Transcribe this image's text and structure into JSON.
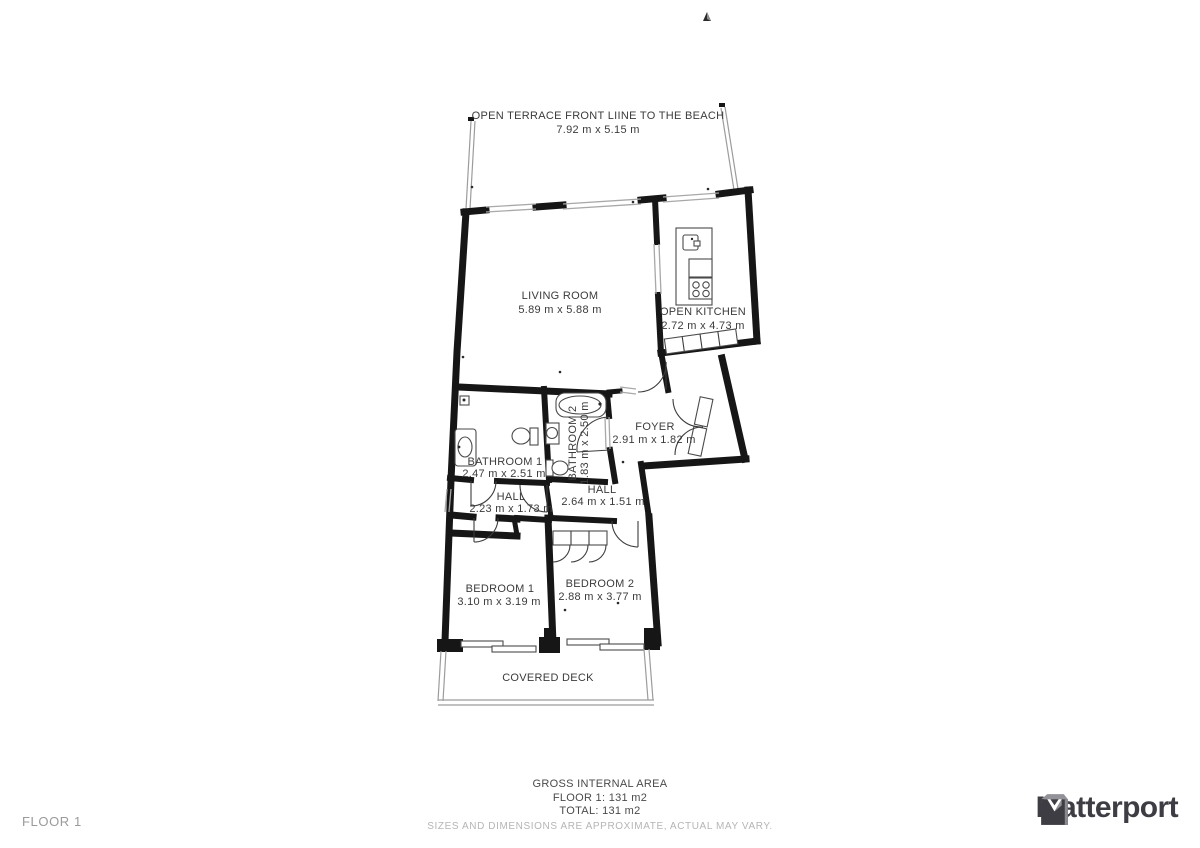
{
  "rooms": {
    "terrace": {
      "name": "OPEN TERRACE FRONT LIINE TO THE BEACH",
      "dims": "7.92 m x 5.15 m"
    },
    "living": {
      "name": "LIVING ROOM",
      "dims": "5.89 m x 5.88 m"
    },
    "kitchen": {
      "name": "OPEN KITCHEN",
      "dims": "2.72 m x 4.73 m"
    },
    "foyer": {
      "name": "FOYER",
      "dims": "2.91 m x 1.82 m"
    },
    "bathroom1": {
      "name": "BATHROOM 1",
      "dims": "2.47 m x 2.51 m"
    },
    "bathroom2": {
      "name": "BATHROOM 2",
      "dims": "1.83 m x 2.50 m"
    },
    "hall1": {
      "name": "HALL",
      "dims": "2.23 m x 1.73 m"
    },
    "hall2": {
      "name": "HALL",
      "dims": "2.64 m x 1.51 m"
    },
    "bedroom1": {
      "name": "BEDROOM 1",
      "dims": "3.10 m x 3.19 m"
    },
    "bedroom2": {
      "name": "BEDROOM 2",
      "dims": "2.88 m x 3.77 m"
    },
    "deck": {
      "name": "COVERED DECK"
    }
  },
  "legend": {
    "title": "GROSS INTERNAL AREA",
    "floor": "FLOOR 1: 131 m2",
    "total": "TOTAL: 131 m2",
    "disclaimer": "SIZES AND DIMENSIONS ARE APPROXIMATE, ACTUAL MAY VARY."
  },
  "footer": {
    "floor_label": "FLOOR 1"
  },
  "brand": {
    "name": "Matterport"
  },
  "colors": {
    "wall": "#161616",
    "label_text": "#3b3b3b",
    "muted_text": "#b5b5b5",
    "thin_line": "#a8a8a8",
    "logo": "#3e3d43"
  }
}
